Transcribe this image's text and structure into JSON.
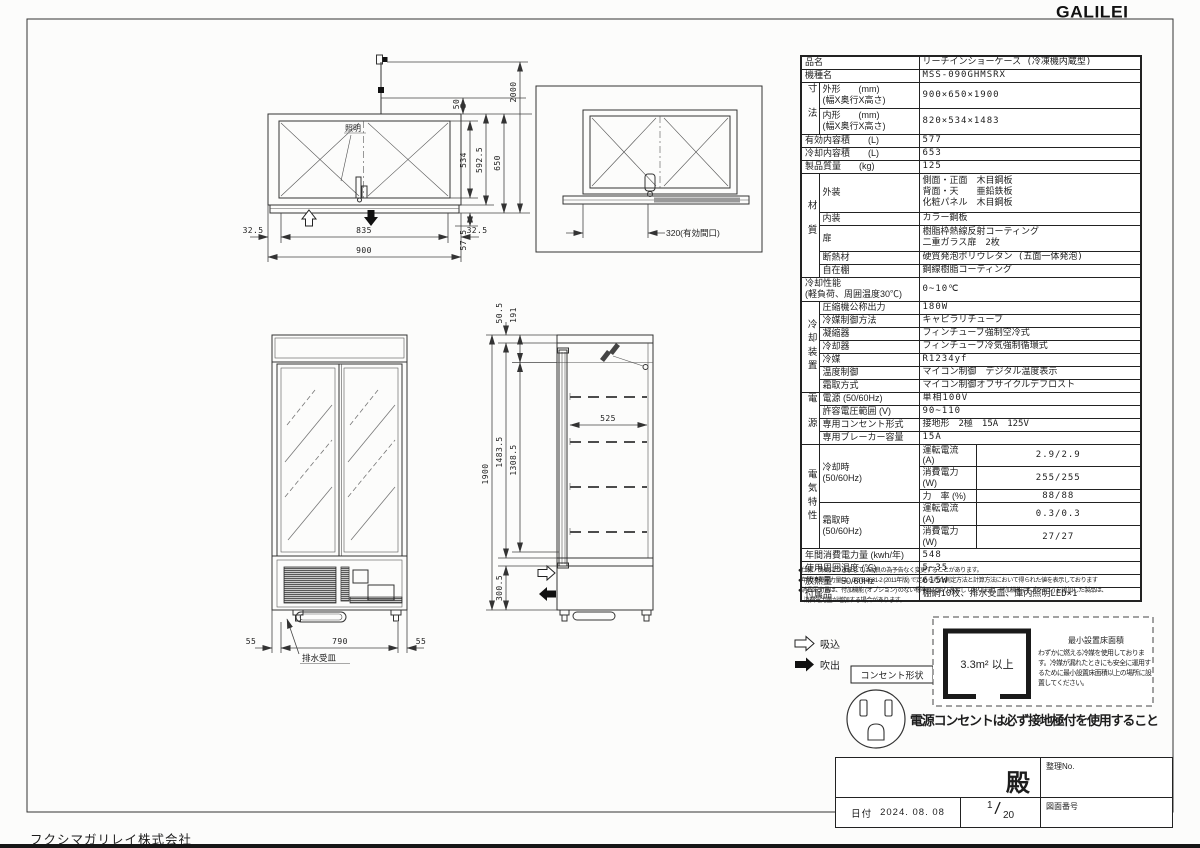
{
  "page": {
    "logo": "GALILEI",
    "company": "フクシマガリレイ株式会社"
  },
  "spec": {
    "name_l": "品名",
    "name_v": "リーチインショーケース (冷凍機内蔵型)",
    "model_l": "機種名",
    "model_v": "MSS-090GHMSRX",
    "size_g": "寸法",
    "size_out_l": "外形　　(mm)\n(幅X奥行X高さ)",
    "size_out_v": "900×650×1900",
    "size_in_l": "内形　　(mm)\n(幅X奥行X高さ)",
    "size_in_v": "820×534×1483",
    "effvol_l": "有効内容積　　(L)",
    "effvol_v": "577",
    "coolvol_l": "冷却内容積　　(L)",
    "coolvol_v": "653",
    "weight_l": "製品質量　　(kg)",
    "weight_v": "125",
    "mat_g": "材質",
    "ext_l": "外装",
    "ext_v": "側面・正面　木目鋼板\n背面・天　　亜鉛鉄板\n化粧パネル　木目鋼板",
    "int_l": "内装",
    "int_v": "カラー鋼板",
    "door_l": "扉",
    "door_v": "樹脂枠熱線反射コーティング\n二重ガラス扉　2枚",
    "insul_l": "断熱材",
    "insul_v": "硬質発泡ポリウレタン (五面一体発泡)",
    "shelf_l": "自在棚",
    "shelf_v": "鋼線樹脂コーティング",
    "perf_l": "冷却性能\n(軽負荷、周囲温度30℃)",
    "perf_v": "0~10℃",
    "cool_g": "冷却装置",
    "comp_l": "圧縮機公称出力",
    "comp_v": "180W",
    "refctl_l": "冷媒制御方法",
    "refctl_v": "キャピラリチューブ",
    "cond_l": "凝縮器",
    "cond_v": "フィンチューブ強制空冷式",
    "evap_l": "冷却器",
    "evap_v": "フィンチューブ冷気強制循環式",
    "refr_l": "冷媒",
    "refr_v": "R1234yf",
    "tempctl_l": "温度制御",
    "tempctl_v": "マイコン制御　デジタル温度表示",
    "defrost_l": "霜取方式",
    "defrost_v": "マイコン制御オフサイクルデフロスト",
    "pow_g": "電源",
    "volt_l": "電源 (50/60Hz)",
    "volt_v": "単相100V",
    "vrange_l": "許容電圧範囲 (V)",
    "vrange_v": "90~110",
    "outlet_l": "専用コンセント形式",
    "outlet_v": "接地形　2極　15A　125V",
    "breaker_l": "専用ブレーカー容量",
    "breaker_v": "15A",
    "elec_g": "電気特性",
    "cooling_l": "冷却時\n(50/60Hz)",
    "cur1_l": "運転電流 (A)",
    "cur1_v": "2.9/2.9",
    "pwr1_l": "消費電力 (W)",
    "pwr1_v": "255/255",
    "pf_l": "力　率 (%)",
    "pf_v": "88/88",
    "defrt_l": "霜取時\n(50/60Hz)",
    "cur2_l": "運転電流 (A)",
    "cur2_v": "0.3/0.3",
    "pwr2_l": "消費電力 (W)",
    "pwr2_v": "27/27",
    "annual_l": "年間消費電力量 (kwh/年)",
    "annual_v": "548",
    "ambient_l": "使用周囲温度 (℃)",
    "ambient_v": "5~35",
    "heat_l": "放熱量　50/60Hz",
    "heat_v": "615W",
    "acc_l": "付属品",
    "acc_v": "棚網10枚、排水受皿、庫内照明LED×1"
  },
  "notes": {
    "n1": "●仕様・外観につきましては改良の為予告なく変更することがあります。",
    "n2": "●年間消費電力量は、JIS B 8631-2 (2011年版) で定められた測定方法と計算方法において得られた値を表示しております",
    "n3": "●消費電力量は、付加機能 (オプション) のない標準品により表示しております。付加機能 (オプション) を追加した製品は、",
    "n4": "　消費電力量が増加する場合があります。"
  },
  "legend": {
    "suction": "吸込",
    "blowout": "吹出",
    "outlet_shape": "コンセント形状"
  },
  "min_area": {
    "title": "最小設置床面積",
    "value": "3.3m² 以上",
    "note": "わずかに燃える冷媒を使用しております。冷媒が漏れたときにも安全に運用するために最小設置床面積以上の場所に設置してください。"
  },
  "warning": "電源コンセントは必ず接地極付を使用すること",
  "titleblock": {
    "tono": "殿",
    "seiri": "整理No.",
    "date_label": "日付",
    "date": "2024. 08. 08",
    "sheet_num": "1",
    "sheet_den": "20",
    "zuban": "図面番号"
  },
  "plan": {
    "cord": "2000",
    "d50": "50",
    "d534": "534",
    "d592": "592.5",
    "d650": "650",
    "d575": "57.5",
    "d325l": "32.5",
    "d835": "835",
    "d325r": "32.5",
    "d900": "900",
    "light": "照明"
  },
  "plan2": {
    "opening": "320(有効間口)"
  },
  "front": {
    "d55l": "55",
    "d790": "790",
    "d55r": "55",
    "drain": "排水受皿"
  },
  "side": {
    "d505": "50.5",
    "d191": "191",
    "d1900": "1900",
    "d14835": "1483.5",
    "d13085": "1308.5",
    "d3005": "300.5",
    "d525": "525"
  }
}
